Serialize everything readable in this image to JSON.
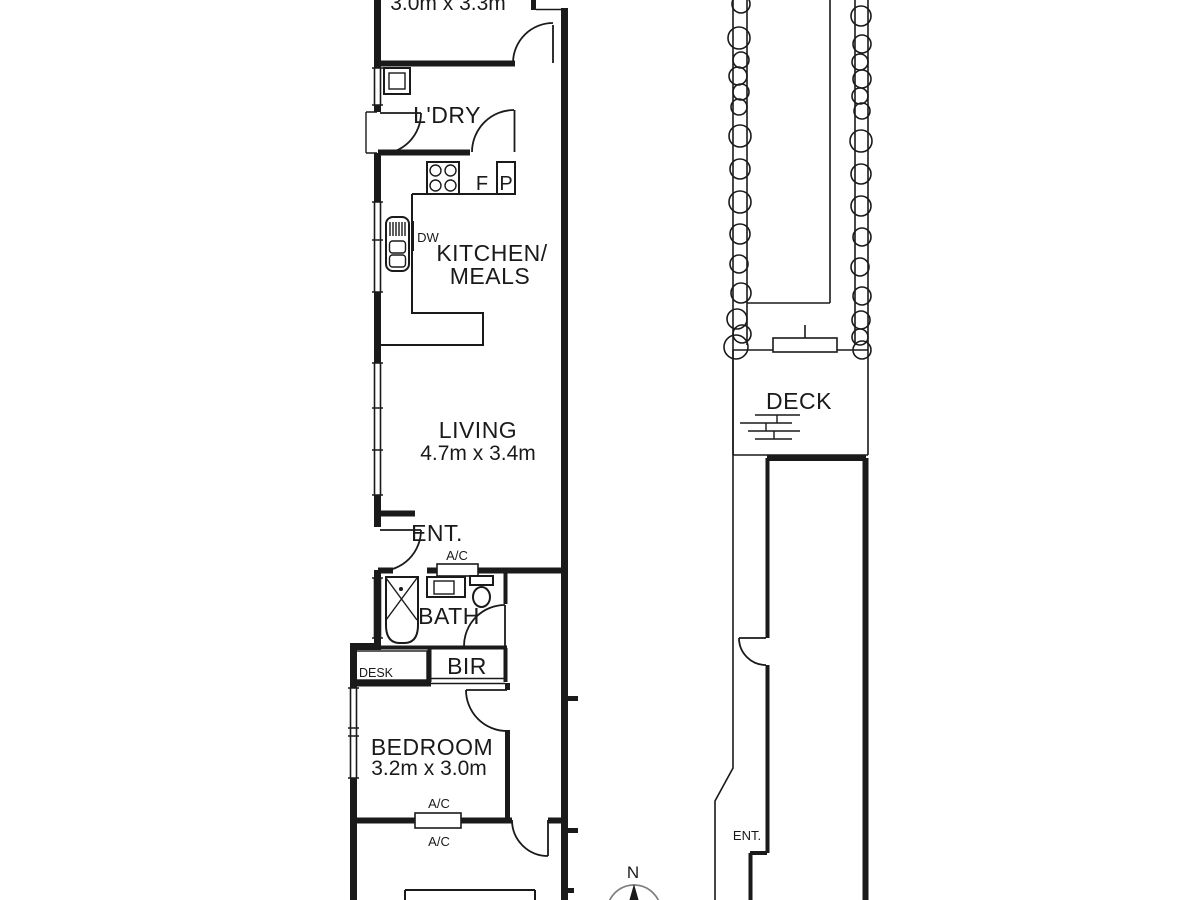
{
  "floorplan": {
    "house": {
      "top_room": {
        "dims": "3.0m x 3.3m"
      },
      "laundry": {
        "label": "L'DRY"
      },
      "kitchen": {
        "line1": "KITCHEN/",
        "line2": "MEALS",
        "fridge": "F",
        "pantry": "P",
        "dishwasher": "DW"
      },
      "living": {
        "label": "LIVING",
        "dims": "4.7m x 3.4m"
      },
      "entry": {
        "label": "ENT."
      },
      "bath": {
        "label": "BATH",
        "ac": "A/C"
      },
      "desk": {
        "label": "DESK"
      },
      "robe": {
        "label": "BIR"
      },
      "bedroom": {
        "label": "BEDROOM",
        "dims": "3.2m x 3.0m",
        "ac_top": "A/C",
        "ac_bottom": "A/C"
      }
    },
    "outdoor": {
      "deck": {
        "label": "DECK"
      },
      "rear_entry": {
        "label": "ENT."
      }
    },
    "compass": {
      "north": "N"
    }
  },
  "colors": {
    "ink": "#1a1a1a",
    "compass_ring": "#7f7f7f"
  }
}
